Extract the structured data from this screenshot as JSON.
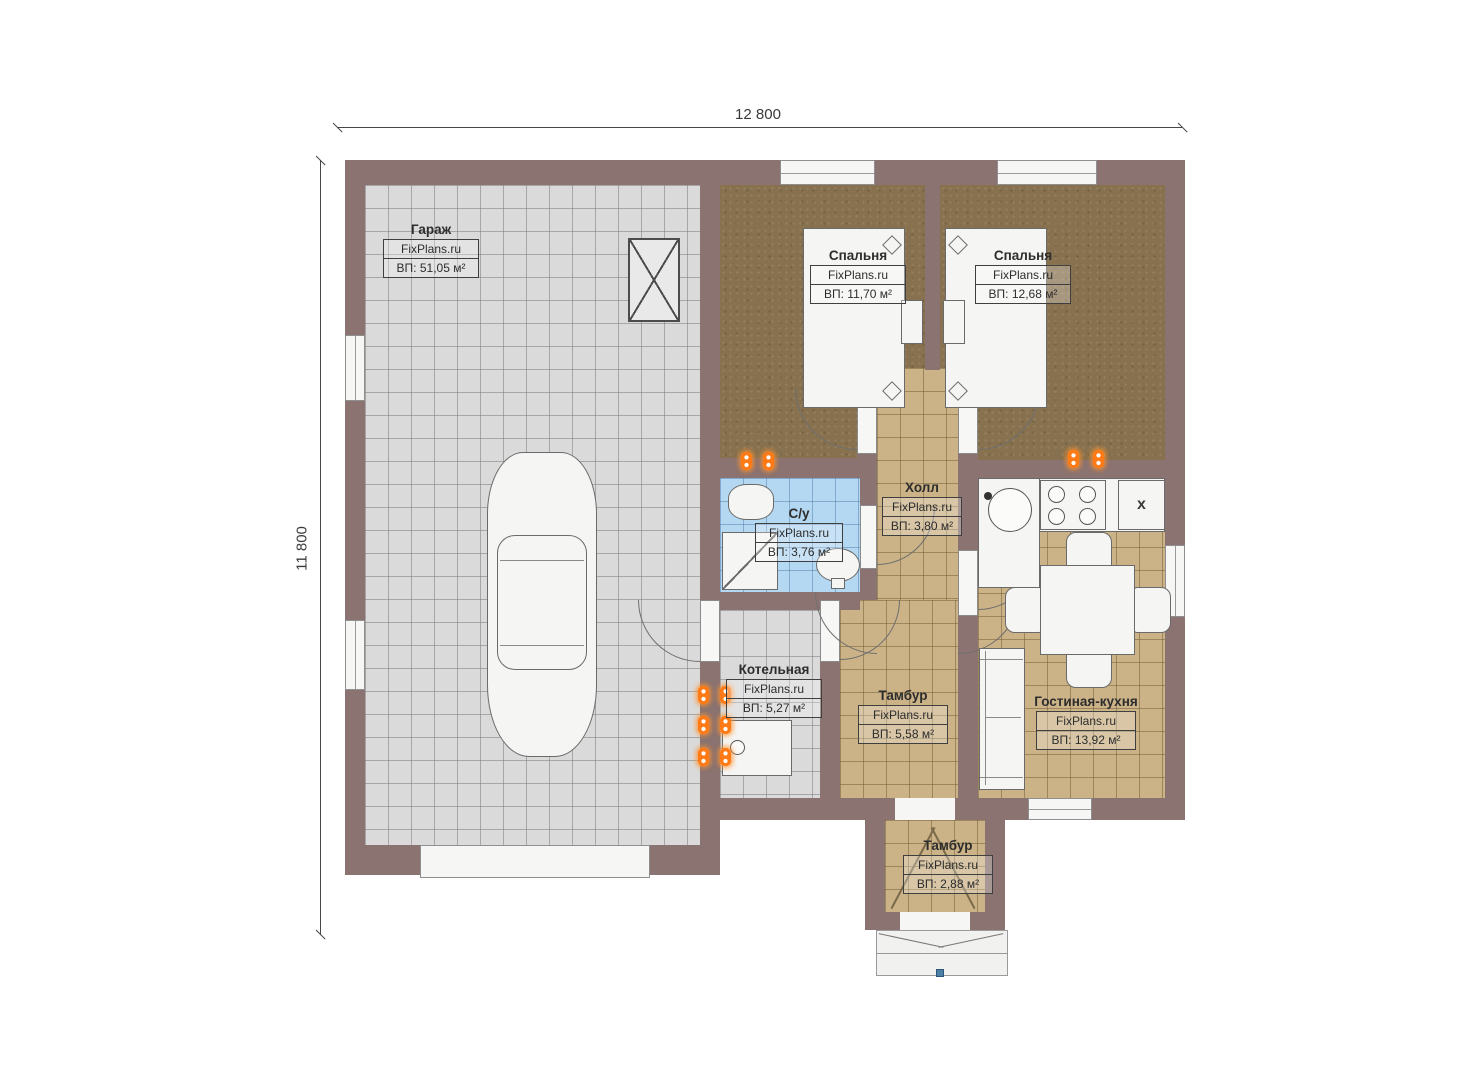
{
  "branding": {
    "watermark": "FixPlans.ru"
  },
  "dimensions": {
    "width_label": "12 800",
    "height_label": "11 800"
  },
  "rooms": {
    "garage": {
      "name": "Гараж",
      "area": "ВП: 51,05 м²"
    },
    "bedroom1": {
      "name": "Спальня",
      "area": "ВП: 11,70 м²"
    },
    "bedroom2": {
      "name": "Спальня",
      "area": "ВП: 12,68 м²"
    },
    "bathroom": {
      "name": "С/у",
      "area": "ВП: 3,76 м²"
    },
    "hall": {
      "name": "Холл",
      "area": "ВП: 3,80 м²"
    },
    "boiler": {
      "name": "Котельная",
      "area": "ВП: 5,27 м²"
    },
    "tambur1": {
      "name": "Тамбур",
      "area": "ВП: 5,58 м²"
    },
    "living_kitchen": {
      "name": "Гостиная-кухня",
      "area": "ВП: 13,92 м²"
    },
    "tambur2": {
      "name": "Тамбур",
      "area": "ВП: 2,88 м²"
    }
  },
  "appliances": {
    "fridge_label": "x"
  },
  "colors": {
    "wall": "#8a7370",
    "garage_floor": "#dadada",
    "carpet_floor": "#87714e",
    "tile_floor": "#cbb287",
    "bath_tile_floor": "#b4d7f2",
    "fixture_white": "#f5f5f3",
    "outlet_orange": "#ff7a14",
    "porch_marker_blue": "#4a7fa6",
    "dimension_line": "#474747"
  }
}
